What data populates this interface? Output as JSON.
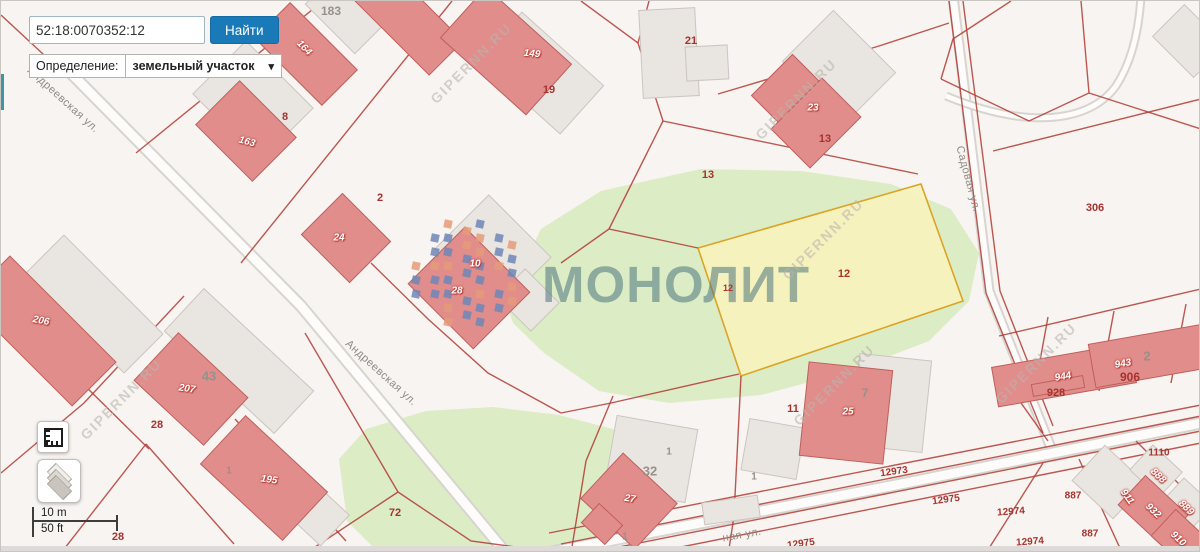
{
  "ui": {
    "search": {
      "value": "52:18:0070352:12",
      "button_label": "Найти"
    },
    "definition": {
      "label": "Определение:",
      "value": "земельный участок",
      "chevron": "▾"
    },
    "scalebar": {
      "metric": "10 m",
      "imperial": "50 ft"
    }
  },
  "watermark": {
    "brand": "МОНОЛИТ",
    "site": "GIPERNN.RU",
    "logo_colors": [
      "#6f86b6",
      "#e59b79"
    ],
    "site_positions": [
      [
        470,
        62
      ],
      [
        795,
        98
      ],
      [
        822,
        238
      ],
      [
        120,
        398
      ],
      [
        833,
        384
      ],
      [
        1035,
        362
      ]
    ]
  },
  "map": {
    "colors": {
      "bg": "#f7f4f1",
      "green": "#dcecc5",
      "road_casing": "#d8d4d0",
      "road_fill": "#fdfcfa",
      "red_line": "#b23b34",
      "bldg_red": "#e08d8b",
      "bldg_red_stroke": "#bf5f5c",
      "bldg_gray": "#e9e5e1",
      "bldg_gray_stroke": "#ccc5bf",
      "highlight_fill": "#f7f2bd",
      "highlight_stroke": "#dba427"
    },
    "greens": [
      "505,300 540,228 600,190 700,168 800,170 890,183 950,208 978,252 968,300 928,340 850,370 760,394 668,402 598,390 543,352 512,322",
      "338,458 365,428 425,410 492,406 558,414 612,428 638,458 636,506 606,540 556,552 378,552 346,520"
    ],
    "roads": [
      {
        "d": "M 58,60 L 300,305 L 505,552",
        "w": 13
      },
      {
        "d": "M 952,-5 L 988,290 L 1052,452",
        "w": 11
      },
      {
        "d": "M 545,552 L 900,483 L 1200,422",
        "w": 13
      },
      {
        "d": "M 945,95 C 1030,130 1090,120 1115,85 C 1130,62 1138,30 1140,-5",
        "w": 9
      }
    ],
    "red_lines": [
      "0,14 56,66",
      "135,152 322,0",
      "451,0 240,262",
      "580,0 637,42",
      "648,0 637,42",
      "637,42 662,120",
      "662,120 917,173",
      "717,93 878,45 948,22",
      "662,120 608,228",
      "608,228 697,247",
      "608,228 560,262",
      "304,332 397,491",
      "397,491 305,552",
      "397,491 470,540 560,552",
      "740,375 733,515 728,548",
      "738,373 610,402 560,412",
      "560,412 487,372 427,318 370,262",
      "612,395 585,460 570,552",
      "548,532 1200,404",
      "560,543 1200,415",
      "588,552 1200,430",
      "650,552 1200,442",
      "1047,316 1032,398",
      "1113,310 1098,390",
      "1185,303 1170,382",
      "998,335 1200,288",
      "1008,385 1047,440",
      "1042,462 985,552",
      "1078,458 1118,545 1128,552",
      "1098,462 1190,552",
      "1135,440 1200,505",
      "1010,0 952,38 940,78",
      "940,78 1028,120",
      "1028,120 1088,92 1080,0",
      "1088,92 1200,128",
      "992,150 1200,98",
      "948,0 985,292 1042,432",
      "962,0 999,290 1052,425",
      "0,302 148,448",
      "183,295 83,402",
      "83,402 0,472",
      "145,443 233,543",
      "145,443 60,552",
      "234,418 345,540"
    ],
    "highlight": {
      "points": "697,247 920,183 962,300 740,375"
    },
    "buildings": [
      [
        252,
        100,
        95,
        75,
        45,
        "g"
      ],
      [
        345,
        12,
        70,
        45,
        45,
        "g"
      ],
      [
        540,
        72,
        110,
        65,
        42,
        "g"
      ],
      [
        668,
        52,
        56,
        88,
        -3,
        "g"
      ],
      [
        706,
        62,
        42,
        34,
        -3,
        "g"
      ],
      [
        838,
        66,
        88,
        72,
        45,
        "g"
      ],
      [
        492,
        252,
        88,
        76,
        45,
        "g"
      ],
      [
        527,
        299,
        48,
        40,
        45,
        "g"
      ],
      [
        93,
        303,
        140,
        55,
        45,
        "g"
      ],
      [
        238,
        360,
        150,
        58,
        43,
        "g"
      ],
      [
        312,
        509,
        60,
        42,
        43,
        "g"
      ],
      [
        650,
        458,
        82,
        74,
        10,
        "g"
      ],
      [
        772,
        448,
        56,
        52,
        10,
        "g"
      ],
      [
        890,
        402,
        72,
        92,
        6,
        "g"
      ],
      [
        1188,
        40,
        58,
        45,
        45,
        "g"
      ],
      [
        1108,
        481,
        56,
        48,
        43,
        "g"
      ],
      [
        1155,
        470,
        40,
        34,
        43,
        "g"
      ],
      [
        1186,
        503,
        40,
        34,
        43,
        "g"
      ],
      [
        730,
        509,
        56,
        22,
        -8,
        "g"
      ],
      [
        245,
        130,
        80,
        62,
        45,
        "r"
      ],
      [
        305,
        53,
        95,
        50,
        45,
        "r"
      ],
      [
        408,
        20,
        105,
        48,
        45,
        "r"
      ],
      [
        505,
        50,
        115,
        68,
        42,
        "r"
      ],
      [
        345,
        237,
        68,
        58,
        45,
        "r"
      ],
      [
        800,
        103,
        82,
        58,
        45,
        "r"
      ],
      [
        815,
        122,
        55,
        72,
        45,
        "r"
      ],
      [
        468,
        287,
        92,
        80,
        45,
        "r"
      ],
      [
        40,
        330,
        150,
        62,
        45,
        "r"
      ],
      [
        190,
        388,
        95,
        65,
        43,
        "r"
      ],
      [
        263,
        477,
        112,
        66,
        43,
        "r"
      ],
      [
        628,
        500,
        74,
        62,
        43,
        "r"
      ],
      [
        601,
        523,
        32,
        26,
        43,
        "r"
      ],
      [
        845,
        412,
        84,
        94,
        6,
        "r"
      ],
      [
        1063,
        374,
        140,
        40,
        -10,
        "r"
      ],
      [
        1165,
        352,
        150,
        44,
        -10,
        "r"
      ],
      [
        1057,
        385,
        52,
        12,
        -10,
        "r"
      ],
      [
        1152,
        509,
        58,
        40,
        43,
        "r"
      ],
      [
        1180,
        538,
        48,
        36,
        43,
        "r"
      ]
    ],
    "labels": {
      "parcel": [
        [
          "8",
          284,
          116,
          0,
          11
        ],
        [
          "2",
          379,
          197,
          0,
          11
        ],
        [
          "19",
          548,
          89,
          0,
          11
        ],
        [
          "21",
          690,
          40,
          0,
          11
        ],
        [
          "13",
          824,
          138,
          0,
          11
        ],
        [
          "13",
          707,
          174,
          0,
          11
        ],
        [
          "12",
          843,
          273,
          0,
          11
        ],
        [
          "12",
          727,
          287,
          0,
          9
        ],
        [
          "11",
          792,
          408,
          0,
          11
        ],
        [
          "72",
          394,
          512,
          0,
          11
        ],
        [
          "28",
          156,
          424,
          0,
          11
        ],
        [
          "306",
          1094,
          207,
          0,
          11
        ],
        [
          "928",
          1055,
          392,
          0,
          11
        ],
        [
          "906",
          1129,
          376,
          0,
          12
        ],
        [
          "12973",
          893,
          471,
          -8,
          10
        ],
        [
          "12975",
          945,
          499,
          -8,
          10
        ],
        [
          "12975",
          800,
          543,
          -8,
          10
        ],
        [
          "12974",
          1010,
          511,
          -4,
          10
        ],
        [
          "12974",
          1029,
          541,
          -4,
          10
        ],
        [
          "887",
          1072,
          495,
          0,
          10
        ],
        [
          "887",
          1089,
          533,
          0,
          10
        ],
        [
          "1110",
          1158,
          452,
          0,
          10
        ],
        [
          "28",
          117,
          536,
          0,
          11
        ]
      ],
      "gray": [
        [
          "183",
          330,
          10,
          0,
          12
        ],
        [
          "43",
          208,
          375,
          0,
          13
        ],
        [
          "32",
          649,
          470,
          0,
          13
        ],
        [
          "1",
          668,
          451,
          0,
          10
        ],
        [
          "1",
          753,
          476,
          0,
          10
        ],
        [
          "1",
          624,
          536,
          0,
          10
        ],
        [
          "1",
          228,
          470,
          0,
          10
        ],
        [
          "7",
          864,
          392,
          0,
          12
        ],
        [
          "2",
          1146,
          355,
          0,
          13
        ]
      ],
      "house": [
        [
          "164",
          303,
          47,
          45,
          10
        ],
        [
          "163",
          246,
          141,
          15,
          10
        ],
        [
          "149",
          531,
          53,
          5,
          10
        ],
        [
          "24",
          338,
          237,
          0,
          10
        ],
        [
          "23",
          812,
          107,
          0,
          10
        ],
        [
          "10",
          474,
          263,
          0,
          10
        ],
        [
          "28",
          456,
          290,
          0,
          10
        ],
        [
          "206",
          40,
          320,
          10,
          10
        ],
        [
          "207",
          186,
          388,
          8,
          10
        ],
        [
          "195",
          268,
          479,
          8,
          10
        ],
        [
          "27",
          629,
          498,
          8,
          10
        ],
        [
          "25",
          847,
          411,
          0,
          10
        ],
        [
          "944",
          1062,
          376,
          -10,
          10
        ],
        [
          "943",
          1122,
          363,
          -10,
          10
        ],
        [
          "932",
          1152,
          510,
          43,
          10
        ],
        [
          "911",
          1126,
          496,
          55,
          10
        ],
        [
          "888",
          1157,
          475,
          43,
          10
        ],
        [
          "889",
          1185,
          507,
          43,
          10
        ],
        [
          "910",
          1177,
          538,
          43,
          10
        ]
      ],
      "street": [
        [
          "Андреевская ул.",
          62,
          99,
          42
        ],
        [
          "Андреевская ул.",
          380,
          372,
          42
        ],
        [
          "Садовая ул.",
          967,
          178,
          75
        ],
        [
          "ная ул.",
          741,
          534,
          -10
        ]
      ]
    }
  }
}
